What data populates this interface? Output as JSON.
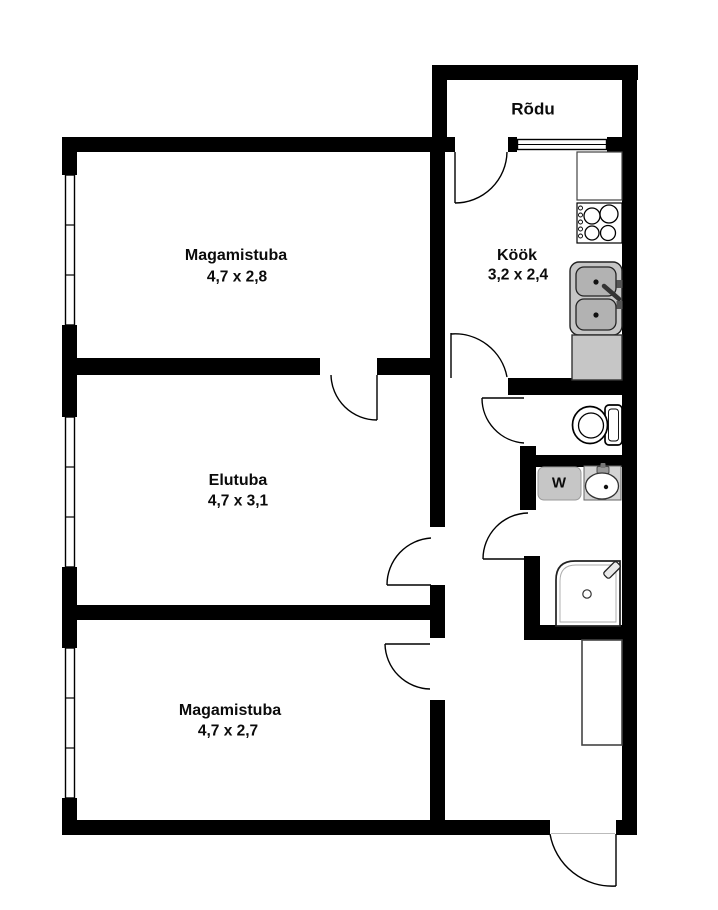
{
  "floorplan": {
    "balcony": {
      "label": "Rõdu"
    },
    "rooms": [
      {
        "name": "Magamistuba",
        "dims": "4,7 x 2,8"
      },
      {
        "name": "Köök",
        "dims": "3,2 x 2,4"
      },
      {
        "name": "Elutuba",
        "dims": "4,7 x 3,1"
      },
      {
        "name": "Magamistuba",
        "dims": "4,7 x 2,7"
      }
    ],
    "labels": {
      "washing_machine": "W"
    },
    "colors": {
      "wall": "#000000",
      "background": "#ffffff",
      "fixture_gray": "#c6c6c6",
      "basin_gray": "#b2b2b2",
      "sink_square_gray": "#d4d4d4",
      "text": "#0b0b0b"
    }
  }
}
